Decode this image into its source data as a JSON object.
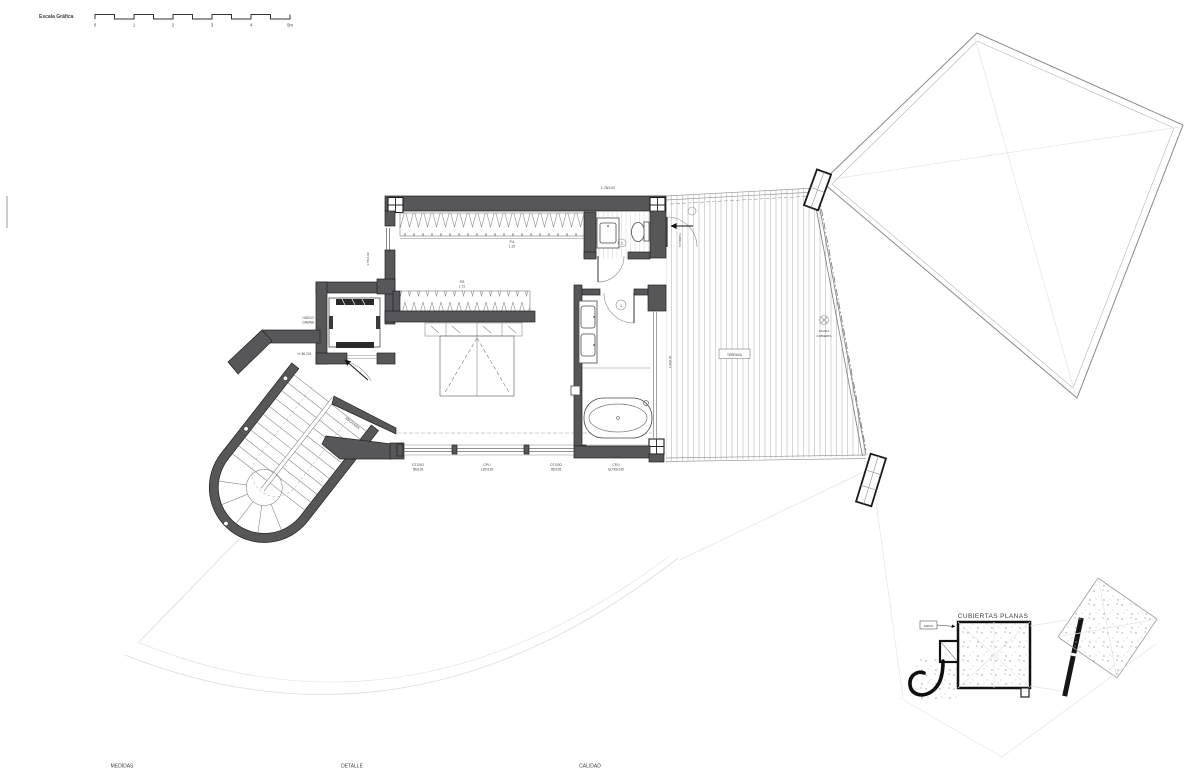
{
  "scale_bar": {
    "label": "Escala Gráfica",
    "ticks": [
      "0",
      "1",
      "2",
      "3",
      "4",
      "5m"
    ]
  },
  "plan": {
    "dims": {
      "top": "1.78/1.02",
      "left": "1.78x1.90",
      "bath": "1.90/2.40"
    },
    "dressing": {
      "tag": "P.A",
      "tag_sub": "1.15"
    },
    "bedroom_closet": {
      "tag": "P.B",
      "tag_sub": "1.72"
    },
    "elevator": {
      "l1": "HUECO",
      "l2": "CABINA",
      "h": "H: 80 CM"
    },
    "stairs_label": "ESCALERA",
    "terrace": {
      "box": "TERRAZA",
      "door_text": "TERRAZA",
      "drain1": "SALIDA",
      "drain2": "CUBIERTA"
    },
    "doors": {
      "bath": "1",
      "wc": "2"
    },
    "window_tags": [
      {
        "code": "OT.OSO",
        "size": "95x135"
      },
      {
        "code": "CP.U",
        "size": "120x135"
      },
      {
        "code": "OT.OSO",
        "size": "95x135"
      },
      {
        "code": "CP.U",
        "size": "SU 95x135"
      }
    ]
  },
  "inset": {
    "title": "CUBIERTAS PLANAS",
    "tag": "GRIFO"
  },
  "footer": {
    "labels": [
      "MEDIDAS",
      "DETALLE",
      "CALIDAD"
    ]
  },
  "colors": {
    "wall": "#57575a",
    "ink": "#232323",
    "plank": "#cbcbcb"
  }
}
